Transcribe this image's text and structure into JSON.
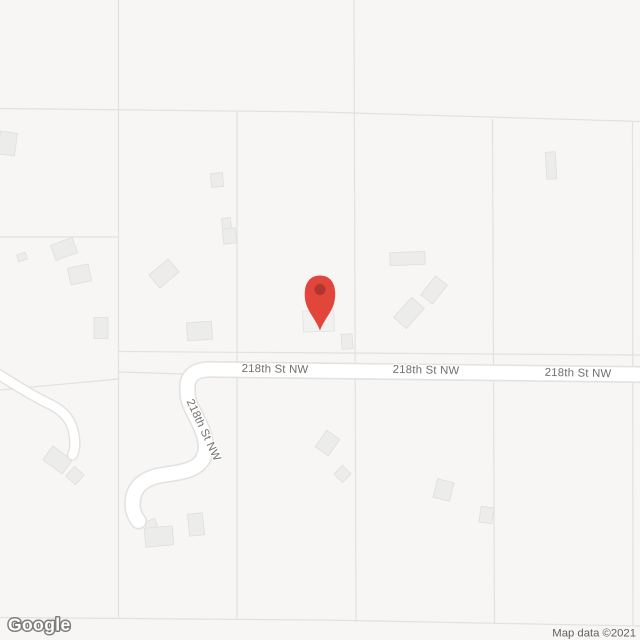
{
  "map": {
    "kind": "road-map",
    "road_labels": [
      {
        "text": "218th St NW",
        "orientation": "horizontal"
      },
      {
        "text": "218th St NW",
        "orientation": "horizontal"
      },
      {
        "text": "218th St NW",
        "orientation": "horizontal"
      },
      {
        "text": "218th St NW",
        "orientation": "rotated-along-road"
      }
    ],
    "marker": {
      "type": "location-pin",
      "color": "#E2453A",
      "inner_color": "#AE382E"
    },
    "colors": {
      "background": "#F7F6F4",
      "parcel_line": "#E2E1DF",
      "building_fill": "#ECECEA",
      "building_stroke": "#DFDEDD",
      "road_fill": "#FFFFFF",
      "road_casing": "#E3E2E0",
      "road_label_text": "#6E6E6E"
    }
  },
  "footer": {
    "logo_text": "Google",
    "attribution": "Map data ©2021"
  }
}
